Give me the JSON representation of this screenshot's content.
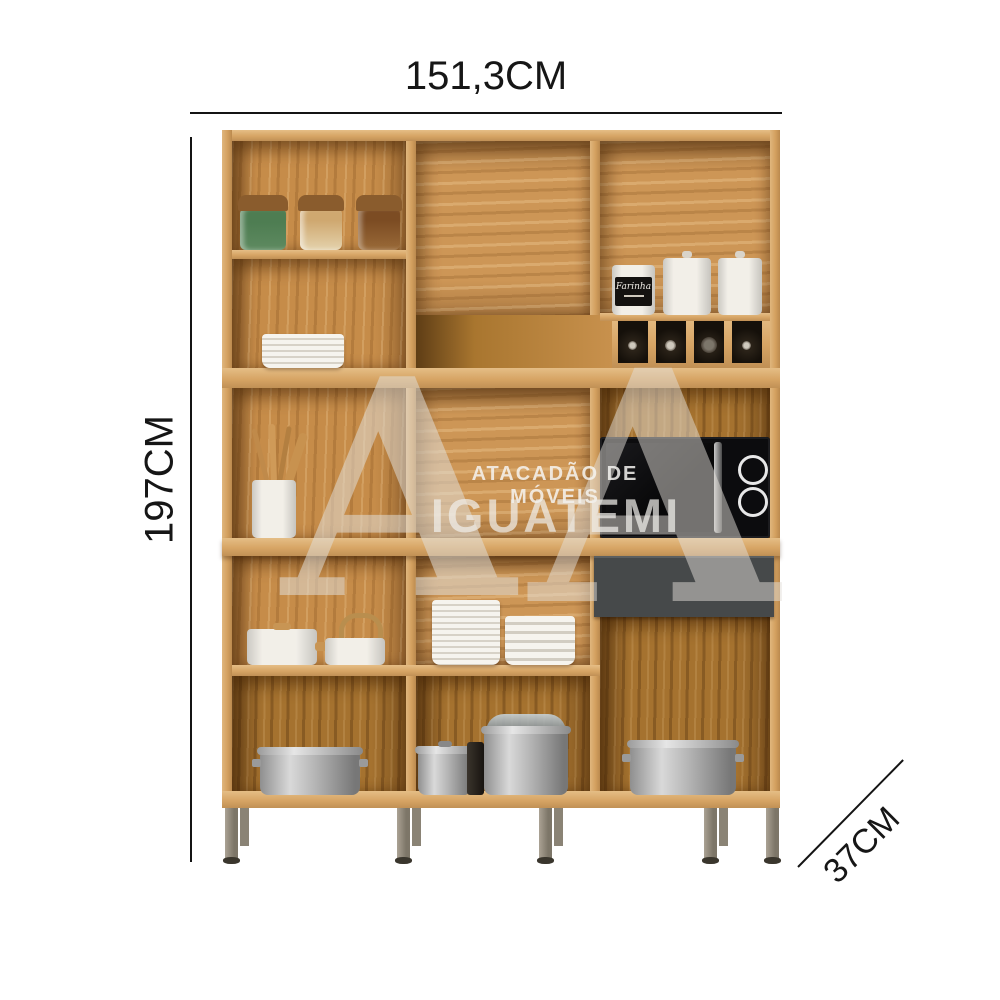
{
  "annotations": {
    "width_label": "151,3CM",
    "height_label": "197CM",
    "depth_label": "37CM"
  },
  "watermark": {
    "line1": "ATACADÃO DE MÓVEIS",
    "line2": "IGUATEMI",
    "monogram_left": "A",
    "monogram_right": "A"
  },
  "cabinet": {
    "canister_label": "Farinha",
    "objects": [
      "spice-jars",
      "plate-stack",
      "utensil-holder",
      "canisters",
      "wine-cubbies",
      "microwave",
      "gray-drawer",
      "white-pot",
      "kettle",
      "steel-pots",
      "metal-legs"
    ]
  },
  "colors": {
    "background": "#ffffff",
    "wood": "#cd9455",
    "wood_dark": "#a5722f",
    "drawer": "#46494a",
    "microwave": "#0d0d0f",
    "dimension_text": "#161616",
    "watermark": "#e6e2dc",
    "legs": "#8e8678"
  }
}
